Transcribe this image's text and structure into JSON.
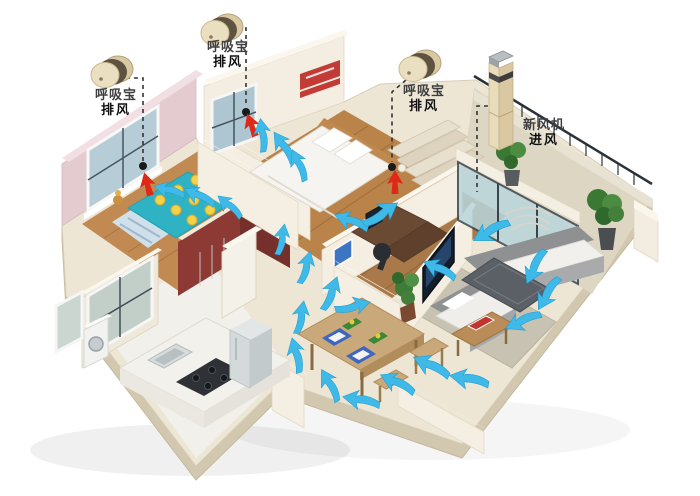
{
  "devices": [
    {
      "id": "exhaust-1",
      "type": "cylinder",
      "label": {
        "line1": "呼吸宝",
        "line2": "排风"
      },
      "leader": [
        [
          126,
          78
        ],
        [
          143,
          78
        ],
        [
          143,
          161
        ]
      ],
      "vent": [
        143,
        166
      ]
    },
    {
      "id": "exhaust-2",
      "type": "cylinder",
      "label": {
        "line1": "呼吸宝",
        "line2": "排风"
      },
      "leader": [
        [
          237,
          28
        ],
        [
          246,
          28
        ],
        [
          246,
          107
        ]
      ],
      "vent": [
        246,
        112
      ]
    },
    {
      "id": "exhaust-3",
      "type": "cylinder",
      "label": {
        "line1": "呼吸宝",
        "line2": "排风"
      },
      "leader": [
        [
          406,
          80
        ],
        [
          392,
          92
        ],
        [
          392,
          162
        ]
      ],
      "vent": [
        392,
        167
      ]
    },
    {
      "id": "intake-1",
      "type": "tower",
      "label": {
        "line1": "新风机",
        "line2": "进风"
      },
      "leader": [
        [
          488,
          106
        ],
        [
          477,
          106
        ],
        [
          477,
          192
        ]
      ],
      "vent": null
    }
  ],
  "colors": {
    "arrow_blue": "#3FB9E8",
    "arrow_blue_edge": "#1E9CCF",
    "arrow_red": "#E02818",
    "leader": "#333333",
    "vent_dot": "#1a1a1a",
    "wall_cream": "#F4EDE1",
    "wall_pink": "#E4CBD0",
    "wall_red": "#8E3A34",
    "floor_wood": "#B9834A",
    "floor_tile": "#EDE6D5",
    "bed_teal": "#2FB3C4",
    "device_gold": "#EADFC0"
  },
  "flow": {
    "blue_arrows": [
      {
        "x": 170,
        "y": 191,
        "rot": 195,
        "s": 0.75
      },
      {
        "x": 200,
        "y": 197,
        "rot": 205,
        "s": 0.8
      },
      {
        "x": 230,
        "y": 207,
        "rot": 220,
        "s": 0.75
      },
      {
        "x": 262,
        "y": 136,
        "rot": 262,
        "s": 0.8
      },
      {
        "x": 284,
        "y": 148,
        "rot": 235,
        "s": 0.85
      },
      {
        "x": 299,
        "y": 166,
        "rot": 245,
        "s": 0.8
      },
      {
        "x": 352,
        "y": 222,
        "rot": 200,
        "s": 0.85
      },
      {
        "x": 380,
        "y": 214,
        "rot": 325,
        "s": 0.95
      },
      {
        "x": 281,
        "y": 240,
        "rot": 280,
        "s": 0.75
      },
      {
        "x": 305,
        "y": 268,
        "rot": 285,
        "s": 0.8
      },
      {
        "x": 330,
        "y": 294,
        "rot": 290,
        "s": 0.85
      },
      {
        "x": 492,
        "y": 231,
        "rot": 150,
        "s": 0.95
      },
      {
        "x": 536,
        "y": 266,
        "rot": 115,
        "s": 0.9
      },
      {
        "x": 549,
        "y": 293,
        "rot": 120,
        "s": 0.9
      },
      {
        "x": 524,
        "y": 321,
        "rot": 155,
        "s": 0.9
      },
      {
        "x": 470,
        "y": 380,
        "rot": 190,
        "s": 0.95
      },
      {
        "x": 432,
        "y": 367,
        "rot": 205,
        "s": 0.95
      },
      {
        "x": 398,
        "y": 384,
        "rot": 205,
        "s": 0.9
      },
      {
        "x": 362,
        "y": 401,
        "rot": 190,
        "s": 0.9
      },
      {
        "x": 330,
        "y": 386,
        "rot": 240,
        "s": 0.85
      },
      {
        "x": 296,
        "y": 356,
        "rot": 255,
        "s": 0.85
      },
      {
        "x": 300,
        "y": 318,
        "rot": 280,
        "s": 0.8
      },
      {
        "x": 352,
        "y": 306,
        "rot": 345,
        "s": 0.85
      },
      {
        "x": 440,
        "y": 270,
        "rot": 205,
        "s": 0.85
      }
    ],
    "red_arrows": [
      {
        "x": 147,
        "y": 183,
        "rot": -15
      },
      {
        "x": 251,
        "y": 124,
        "rot": -20
      },
      {
        "x": 395,
        "y": 181,
        "rot": 0
      }
    ]
  }
}
